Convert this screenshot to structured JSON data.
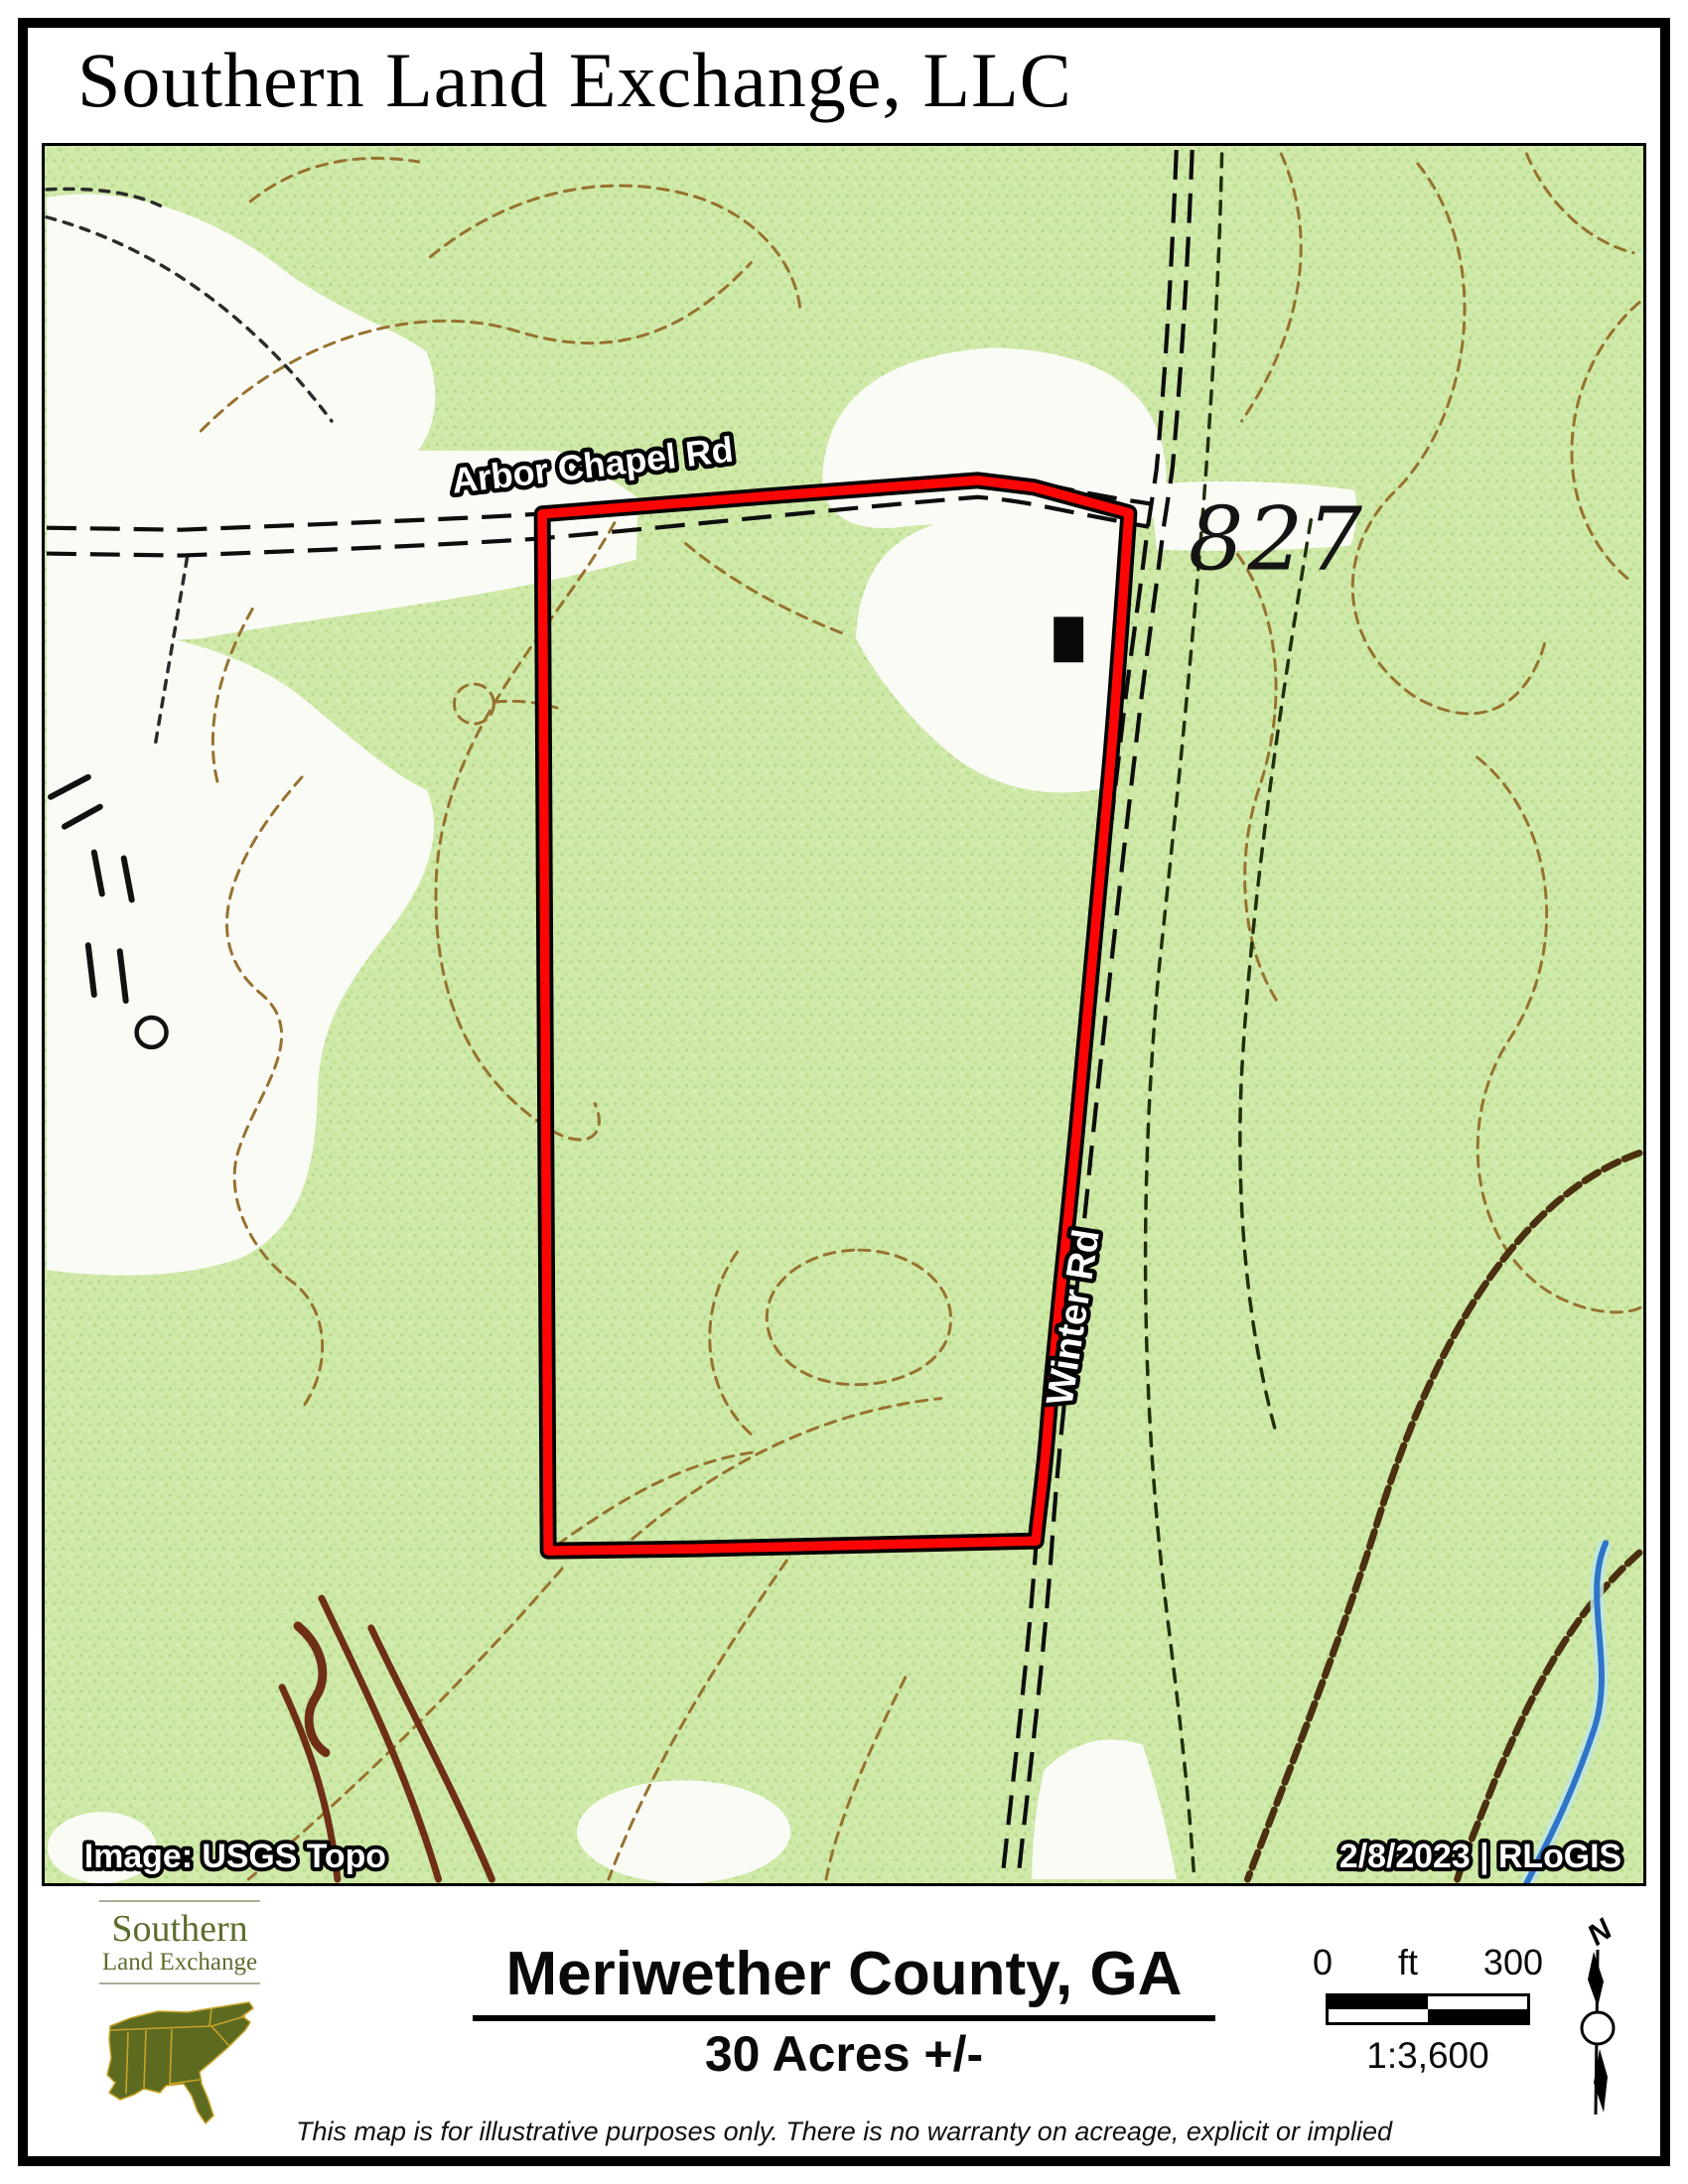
{
  "header": {
    "title": "Southern Land Exchange, LLC"
  },
  "map": {
    "road_top_label": "Arbor Chapel Rd",
    "road_right_label": "Winter Rd",
    "spot_elevation": "827",
    "image_credit": "Image: USGS Topo",
    "date_credit": "2/8/2023  |  RLoGIS",
    "colors": {
      "boundary_red": "#fe0505",
      "forest_green": "#cfe9a8",
      "clearing_white": "#fbfbf6",
      "contour_brown": "#96722f",
      "index_contour_dark": "#6e2f16",
      "stream_blue": "#2e74c9",
      "road_black": "#0d0d0d"
    }
  },
  "footer": {
    "logo_line1": "Southern",
    "logo_line2": "Land Exchange",
    "county_title": "Meriwether County, GA",
    "acreage": "30 Acres +/-",
    "scale_zero": "0",
    "scale_unit": "ft",
    "scale_max": "300",
    "scale_ratio": "1:3,600",
    "north_label": "N",
    "disclaimer": "This map is for illustrative purposes only.  There is no warranty on acreage, explicit or implied"
  }
}
